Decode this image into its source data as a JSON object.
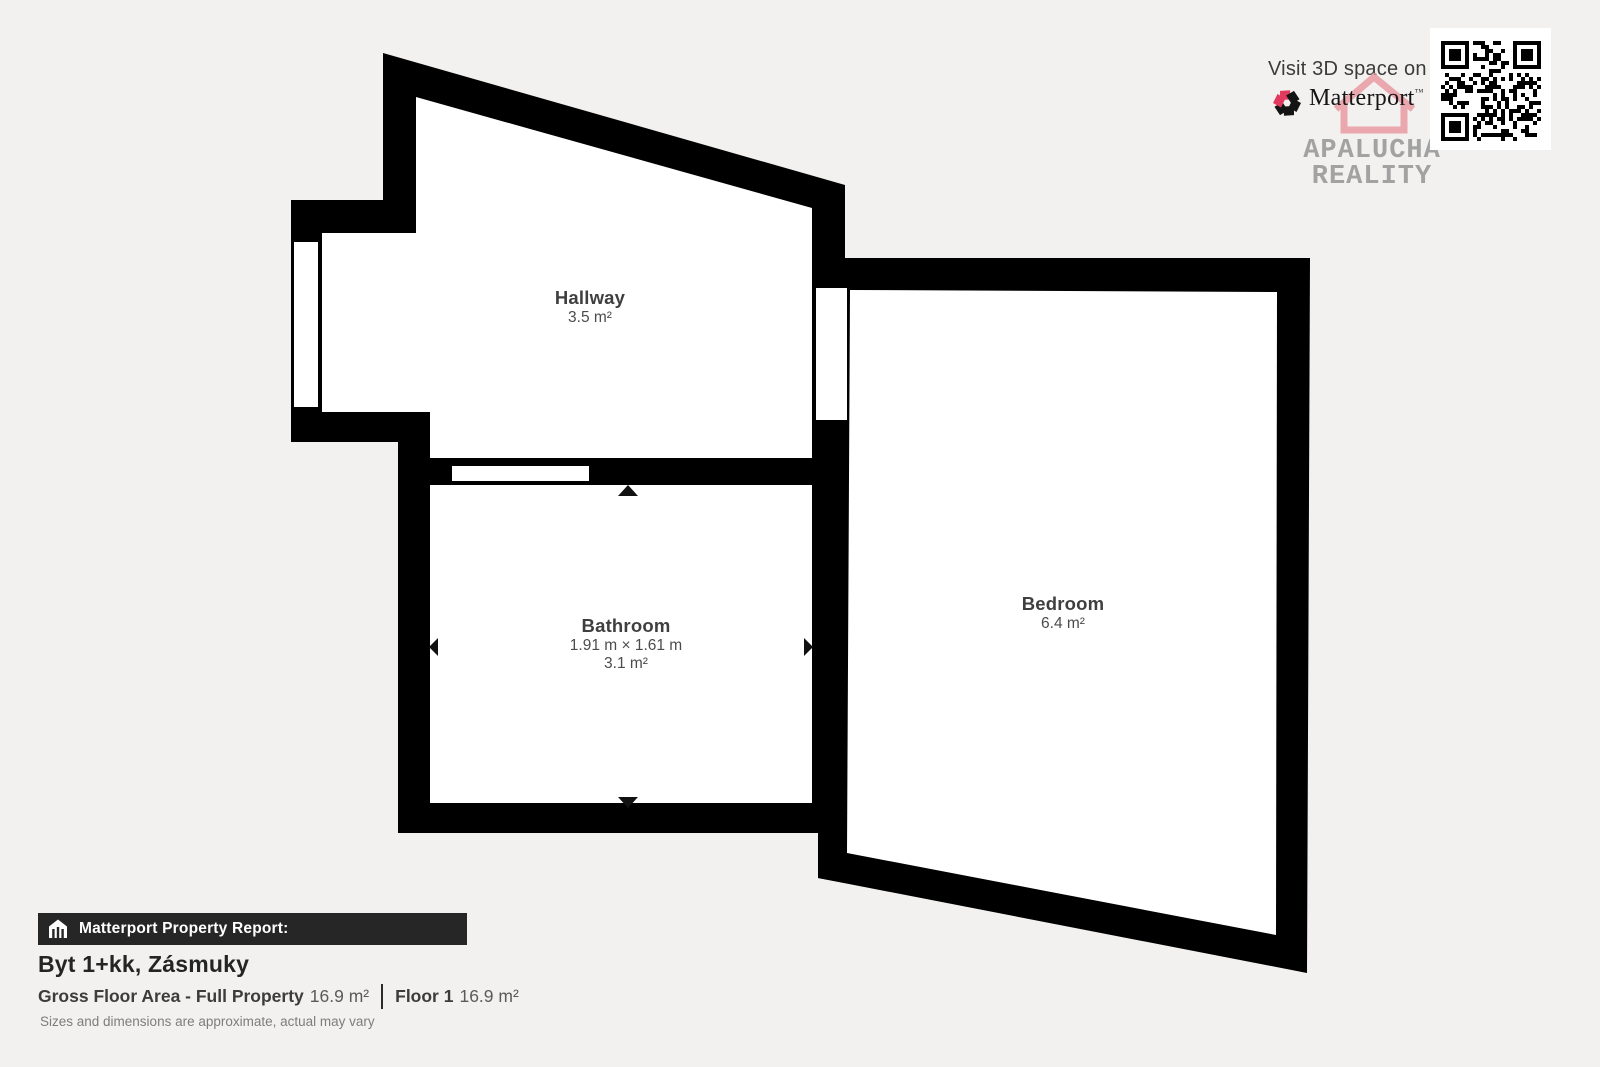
{
  "branding": {
    "visit_text": "Visit 3D space on",
    "logo_text": "Matterport",
    "logo_tm": "™",
    "watermark_line1": "APALUCHA",
    "watermark_line2": "REALITY"
  },
  "rooms": [
    {
      "name": "Hallway",
      "area": "3.5 m²"
    },
    {
      "name": "Bathroom",
      "dimensions": "1.91 m × 1.61 m",
      "area": "3.1 m²"
    },
    {
      "name": "Bedroom",
      "area": "6.4 m²"
    }
  ],
  "report": {
    "bar_label": "Matterport Property Report:",
    "property_title": "Byt 1+kk, Zásmuky",
    "gross_label": "Gross Floor Area - Full Property",
    "gross_value": "16.9 m²",
    "floor_label": "Floor 1",
    "floor_value": "16.9 m²",
    "disclaimer": "Sizes and dimensions are approximate, actual may vary"
  },
  "colors": {
    "background": "#f2f1ef",
    "walls": "#000000",
    "matterport_red": "#e23a5f",
    "watermark_pink": "#e9959f",
    "watermark_gray": "#a2a2a2"
  }
}
